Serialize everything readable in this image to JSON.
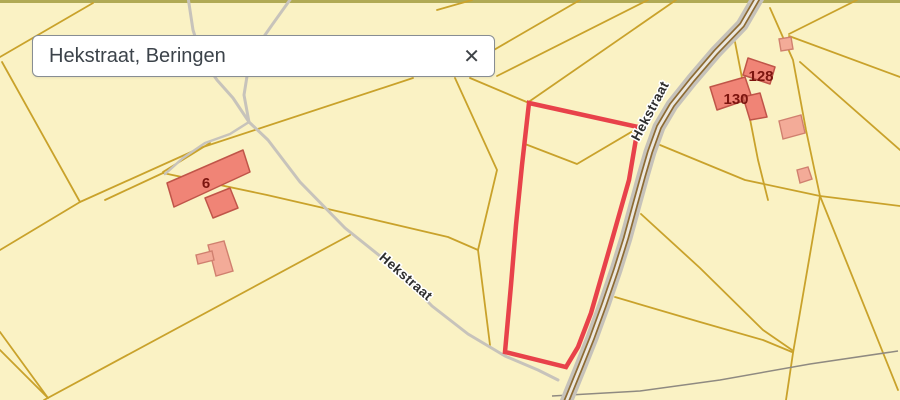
{
  "search_box": {
    "value": "Hekstraat, Beringen",
    "clear_icon": "✕"
  },
  "map": {
    "street_labels": [
      {
        "text": "Hekstraat"
      },
      {
        "text": "Hekstraat"
      }
    ],
    "house_numbers": [
      {
        "text": "6"
      },
      {
        "text": "128"
      },
      {
        "text": "130"
      }
    ],
    "colors": {
      "parcel_fill": "#faf2c4",
      "parcel_line": "#c9a22b",
      "top_strip": "#b0aa55",
      "road_casing": "#c6c2ba",
      "road_edge": "#8d6b33",
      "road_center": "#ece8df",
      "path": "#c7c3bb",
      "track": "#8f8a81",
      "selection_outline": "#e8424a",
      "building_fill": "#f08476",
      "building_stroke": "#c05549",
      "building_light_fill": "#f3ab98",
      "building_light_stroke": "#d0806f",
      "house_number_color": "#7c150f",
      "street_label_color": "#2e2e2e"
    }
  }
}
